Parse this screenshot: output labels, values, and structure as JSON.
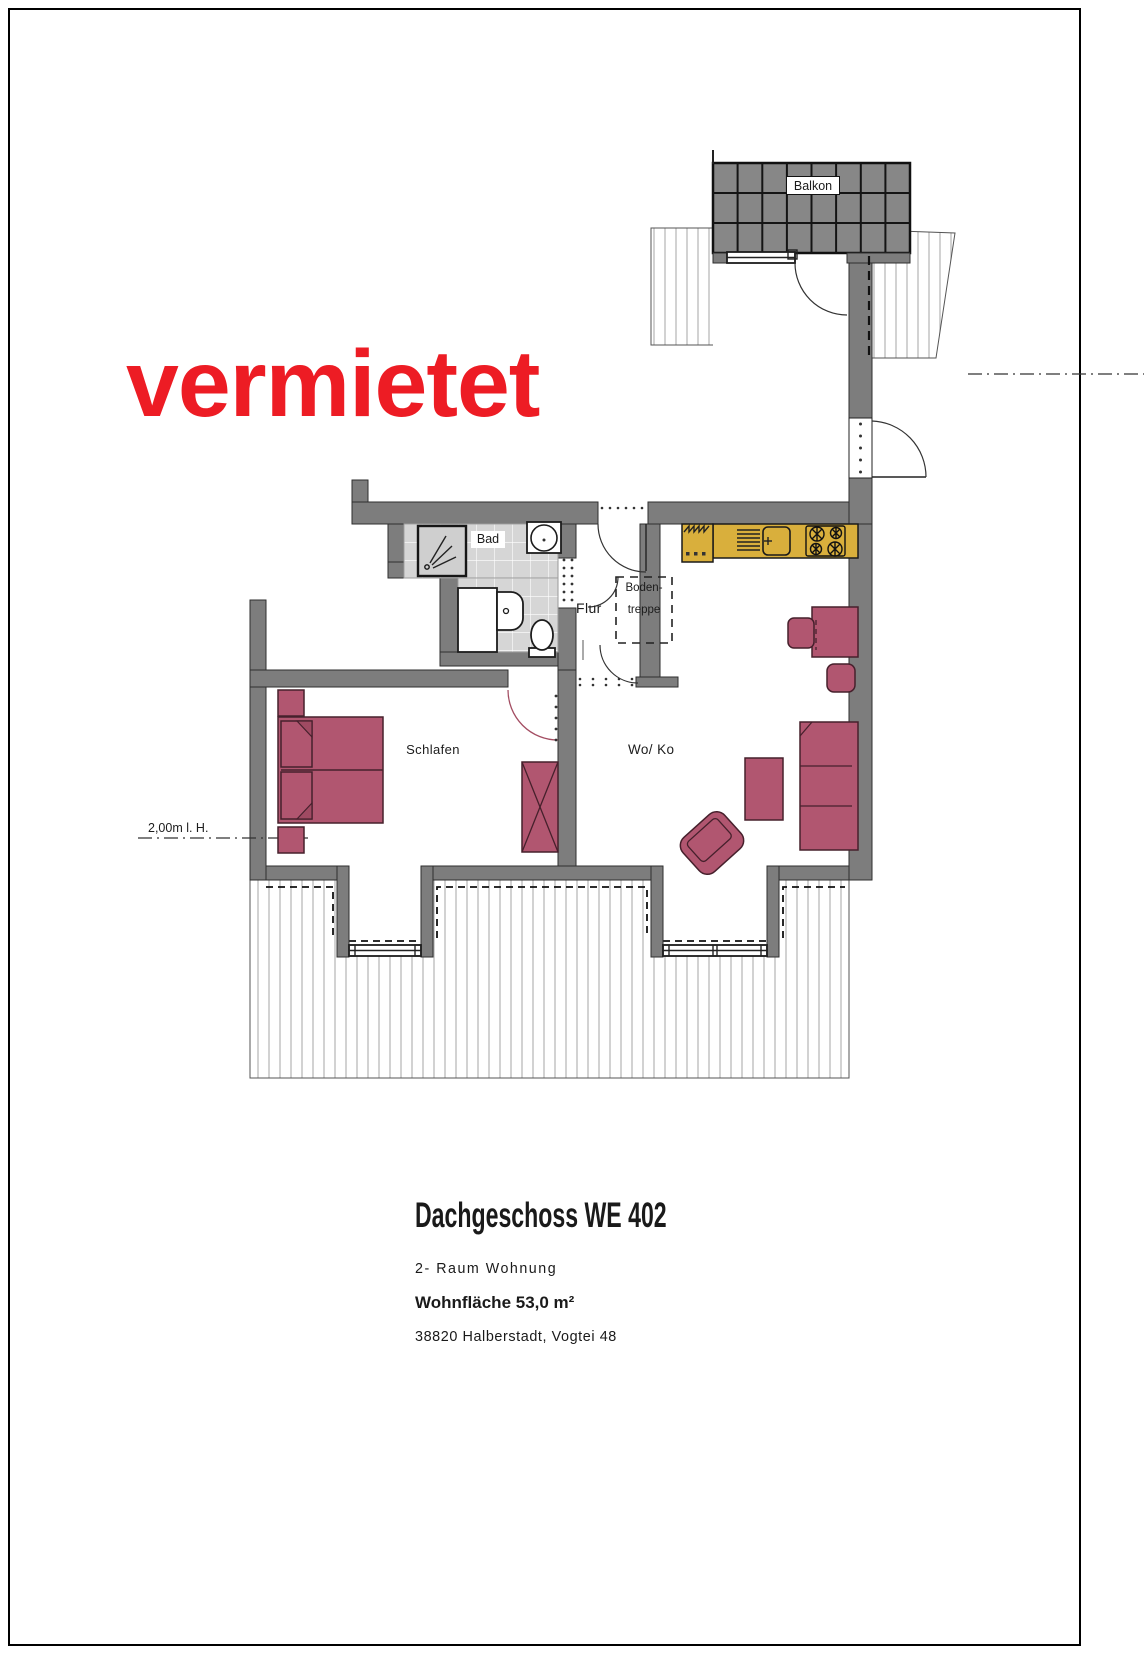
{
  "stamp": {
    "text": "vermietet",
    "color": "#ed1c24"
  },
  "plan": {
    "labels": {
      "balkon": "Balkon",
      "bad": "Bad",
      "flur": "Flur",
      "boden_line1": "Boden-",
      "boden_line2": "treppe",
      "schlafen": "Schlafen",
      "woko": "Wo/ Ko",
      "ceiling_height": "2,00m l. H."
    },
    "colors": {
      "wall": "#7d7d7d",
      "furniture": "#b15670",
      "counter": "#d9af3c",
      "tiles": "#d6d6d6",
      "balcony": "#878787"
    }
  },
  "info": {
    "title": "Dachgeschoss WE 402",
    "subtitle": "2- Raum Wohnung",
    "area": "Wohnfläche 53,0 m²",
    "address": "38820 Halberstadt, Vogtei 48"
  }
}
